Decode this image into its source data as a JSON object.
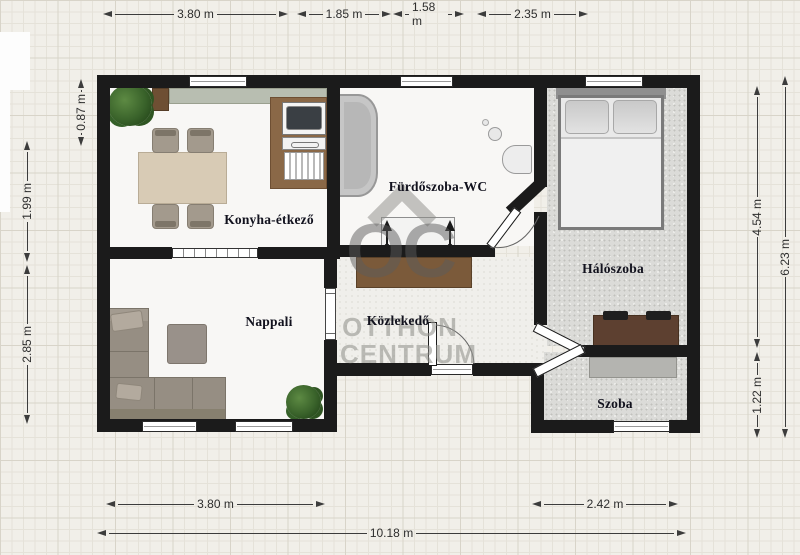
{
  "plan": {
    "rooms": {
      "kitchen": "Konyha-étkező",
      "bathroom": "Fürdőszoba-WC",
      "bedroom": "Hálószoba",
      "living": "Nappali",
      "hall": "Közlekedő",
      "room": "Szoba"
    },
    "dimensions": {
      "top": [
        "3.80 m",
        "1.85 m",
        "1.58 m",
        "2.35 m"
      ],
      "bottom": [
        "3.80 m",
        "2.42 m",
        "10.18 m"
      ],
      "left": [
        "0.87 m",
        "1.99 m",
        "2.85 m"
      ],
      "right": [
        "4.54 m",
        "6.23 m",
        "1.22 m"
      ]
    },
    "watermark": {
      "logo": "OC",
      "line1": "OTTHON",
      "line2": "CENTRUM"
    },
    "colors": {
      "wall": "#1b1b1b",
      "background": "#f1efe9",
      "room_label": "#12121e",
      "wood_dark": "#7b5a3a",
      "counter_sage": "#b8beb1",
      "sofa": "#968e83",
      "speckle_floor": "#dbdbd8"
    }
  }
}
